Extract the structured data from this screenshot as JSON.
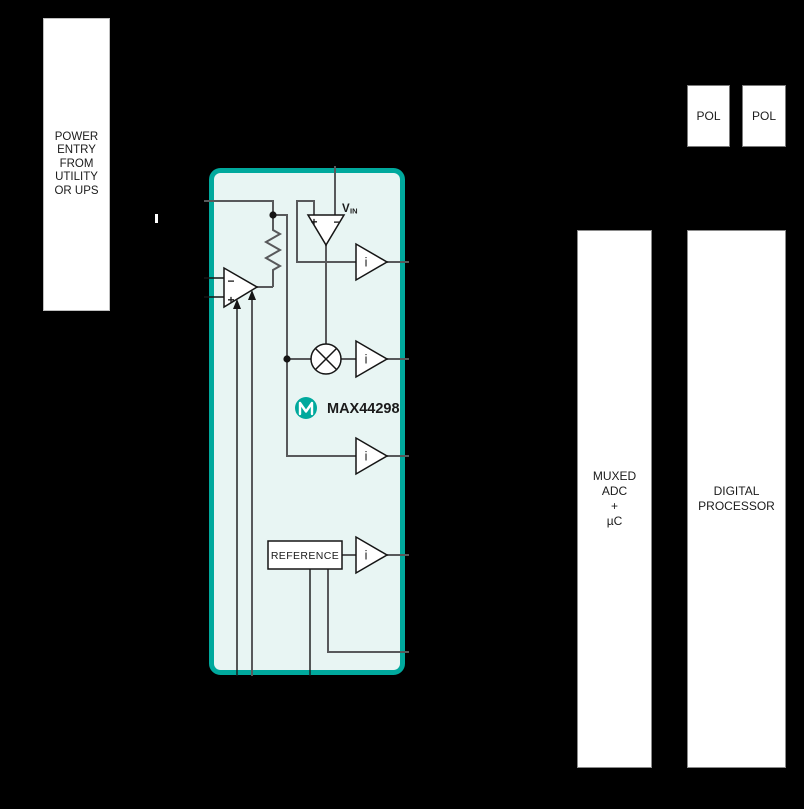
{
  "diagram": {
    "power_entry": {
      "lines": [
        "POWER",
        "ENTRY",
        "FROM",
        "UTILITY",
        "OR UPS"
      ]
    },
    "chip": {
      "name": "MAX44298",
      "vin_label": "V",
      "vin_sub": "IN",
      "reference": "REFERENCE",
      "buffer": "i",
      "comparator_plus": "+",
      "comparator_minus": "−",
      "opamp_plus": "+",
      "opamp_minus": "−"
    },
    "pol_left": "POL",
    "pol_right": "POL",
    "muxed_adc": {
      "lines": [
        "MUXED",
        "ADC",
        "+",
        "µC"
      ]
    },
    "digital_processor": {
      "lines": [
        "DIGITAL",
        "PROCESSOR"
      ]
    }
  },
  "colors": {
    "background": "#000000",
    "teal_accent": "#00A99D",
    "chip_fill": "#E8F5F3",
    "wire_gray": "#58595B",
    "wire_black": "#151515",
    "box_white": "#FFFFFF"
  }
}
